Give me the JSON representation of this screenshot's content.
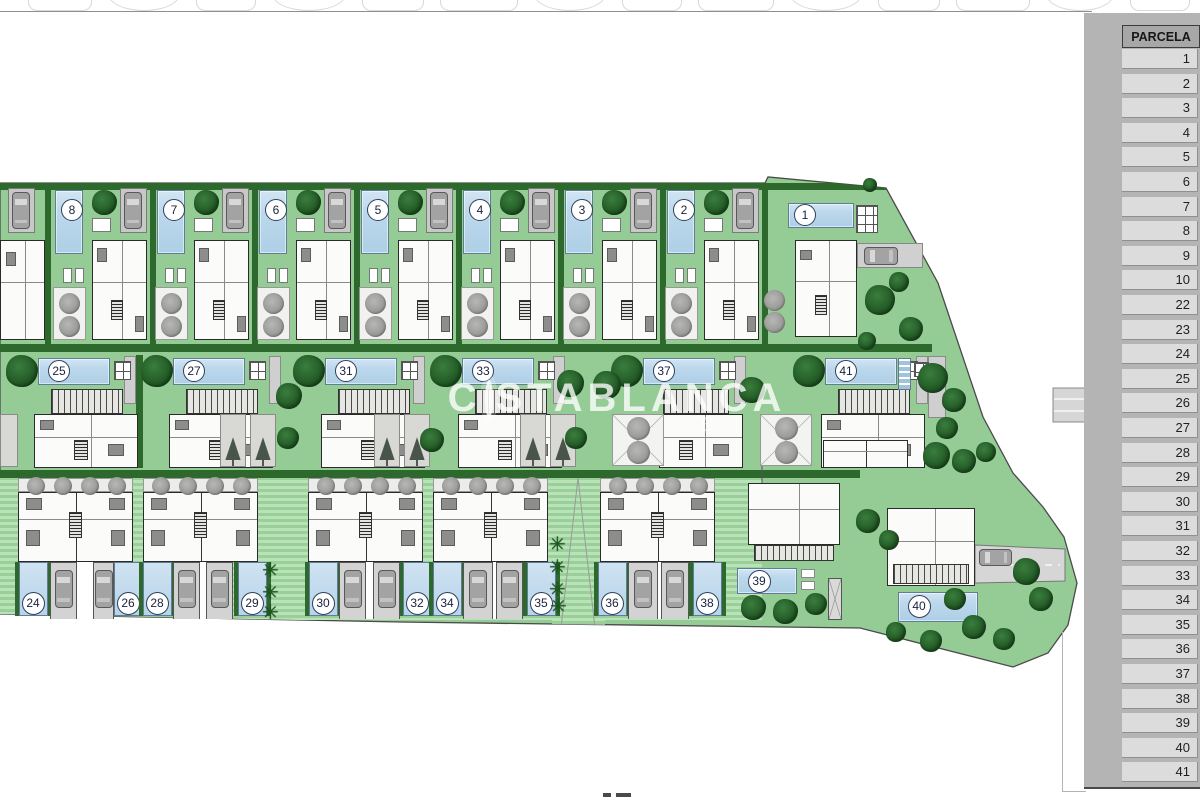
{
  "sidebar": {
    "header": "PARCELA",
    "rows": [
      "1",
      "2",
      "3",
      "4",
      "5",
      "6",
      "7",
      "8",
      "9",
      "10",
      "22",
      "23",
      "24",
      "25",
      "26",
      "27",
      "28",
      "29",
      "30",
      "31",
      "32",
      "33",
      "34",
      "35",
      "36",
      "37",
      "38",
      "39",
      "40",
      "41"
    ]
  },
  "watermark": {
    "left": "C",
    "right": "STABLANCA",
    "script": "e"
  },
  "plan": {
    "row1_labels": [
      "8",
      "7",
      "6",
      "5",
      "4",
      "3",
      "2"
    ],
    "plot1_label": "1",
    "row2_labels": [
      "25",
      "27",
      "31",
      "33",
      "37",
      "41"
    ],
    "bottom_labels": [
      "24",
      "26",
      "28",
      "29",
      "30",
      "32",
      "34",
      "35",
      "36",
      "38"
    ],
    "plot39_label": "39",
    "plot40_label": "40"
  },
  "colors": {
    "site_green": "#95cb95",
    "stripe_light": "#b9e2b9",
    "stripe_dark": "#99d099",
    "hedge_green": "#2d682d",
    "pool_blue": "#b6d4ea",
    "house_wall": "#2a2a2a",
    "garage_gray": "#c8c8c8",
    "car_gray": "#a3a3a3",
    "gray_tree": "#9a9a98",
    "road_gray": "#d6d6d6",
    "sidebar_panel": "#b4b4b4",
    "sidebar_header_bg": "#a7a7a7",
    "sidebar_row_bg": "#dcdcdc",
    "label_ring": "#2f3f5c"
  }
}
